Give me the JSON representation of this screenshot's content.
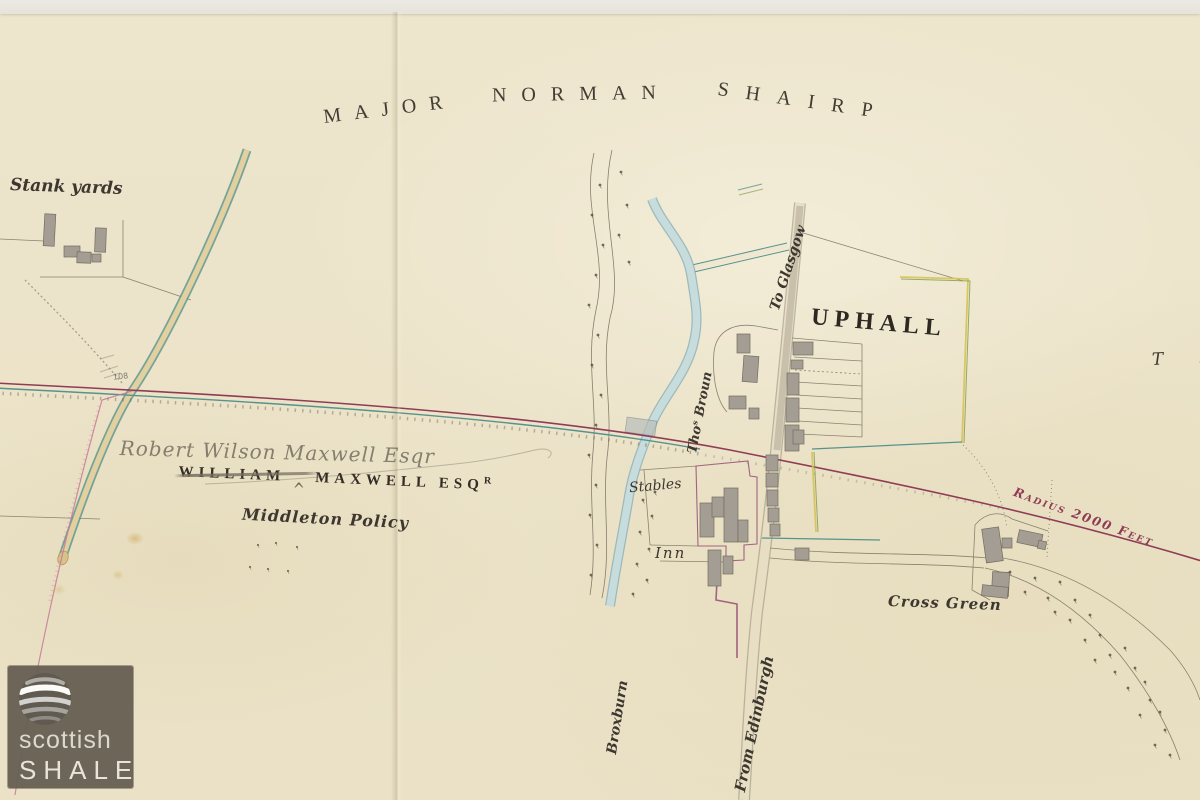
{
  "labels": {
    "estate_name_top": {
      "word1": "MAJOR",
      "word2": "NORMAN",
      "word3": "SHAIRP"
    },
    "stank_yards": "Stank yards",
    "uphall": "UPHALL",
    "to_glasgow": "To Glasgow",
    "from_edinburgh": "From Edinburgh",
    "broxburn": "Broxburn",
    "thos_broun": "Thoˢ Broun",
    "stables": "Stables",
    "inn": "Inn",
    "estate_name_printed": {
      "struck_word": "WILLIAM",
      "rest": "MAXWELL ESQ",
      "superscript": "R"
    },
    "pencil_annotation": "Robert Wilson Maxwell Esqr",
    "insertion_caret": "^",
    "middleton_policy": "Middleton Policy",
    "cross_green": "Cross Green",
    "radius_note": "Radius 2000 Feet",
    "edge_partial_text": "T A",
    "pencil_number": "108"
  },
  "watermark": {
    "line1": "scottish",
    "line2": "SHALE"
  },
  "colors": {
    "paper": "#ece4cb",
    "ink": "#3d372f",
    "railway_maroon": "#8f3c55",
    "survey_teal": "#57938c",
    "road_fill": "#ddc897",
    "stream_blue": "#c6dcdd",
    "building_gray": "#a49d93",
    "boundary_purple": "#9a5577",
    "boundary_pink": "#c77a95",
    "boundary_green": "#85a052",
    "boundary_yellow": "#d6c35a",
    "pencil_gray": "#8b8577",
    "watermark_background": "#676054"
  }
}
